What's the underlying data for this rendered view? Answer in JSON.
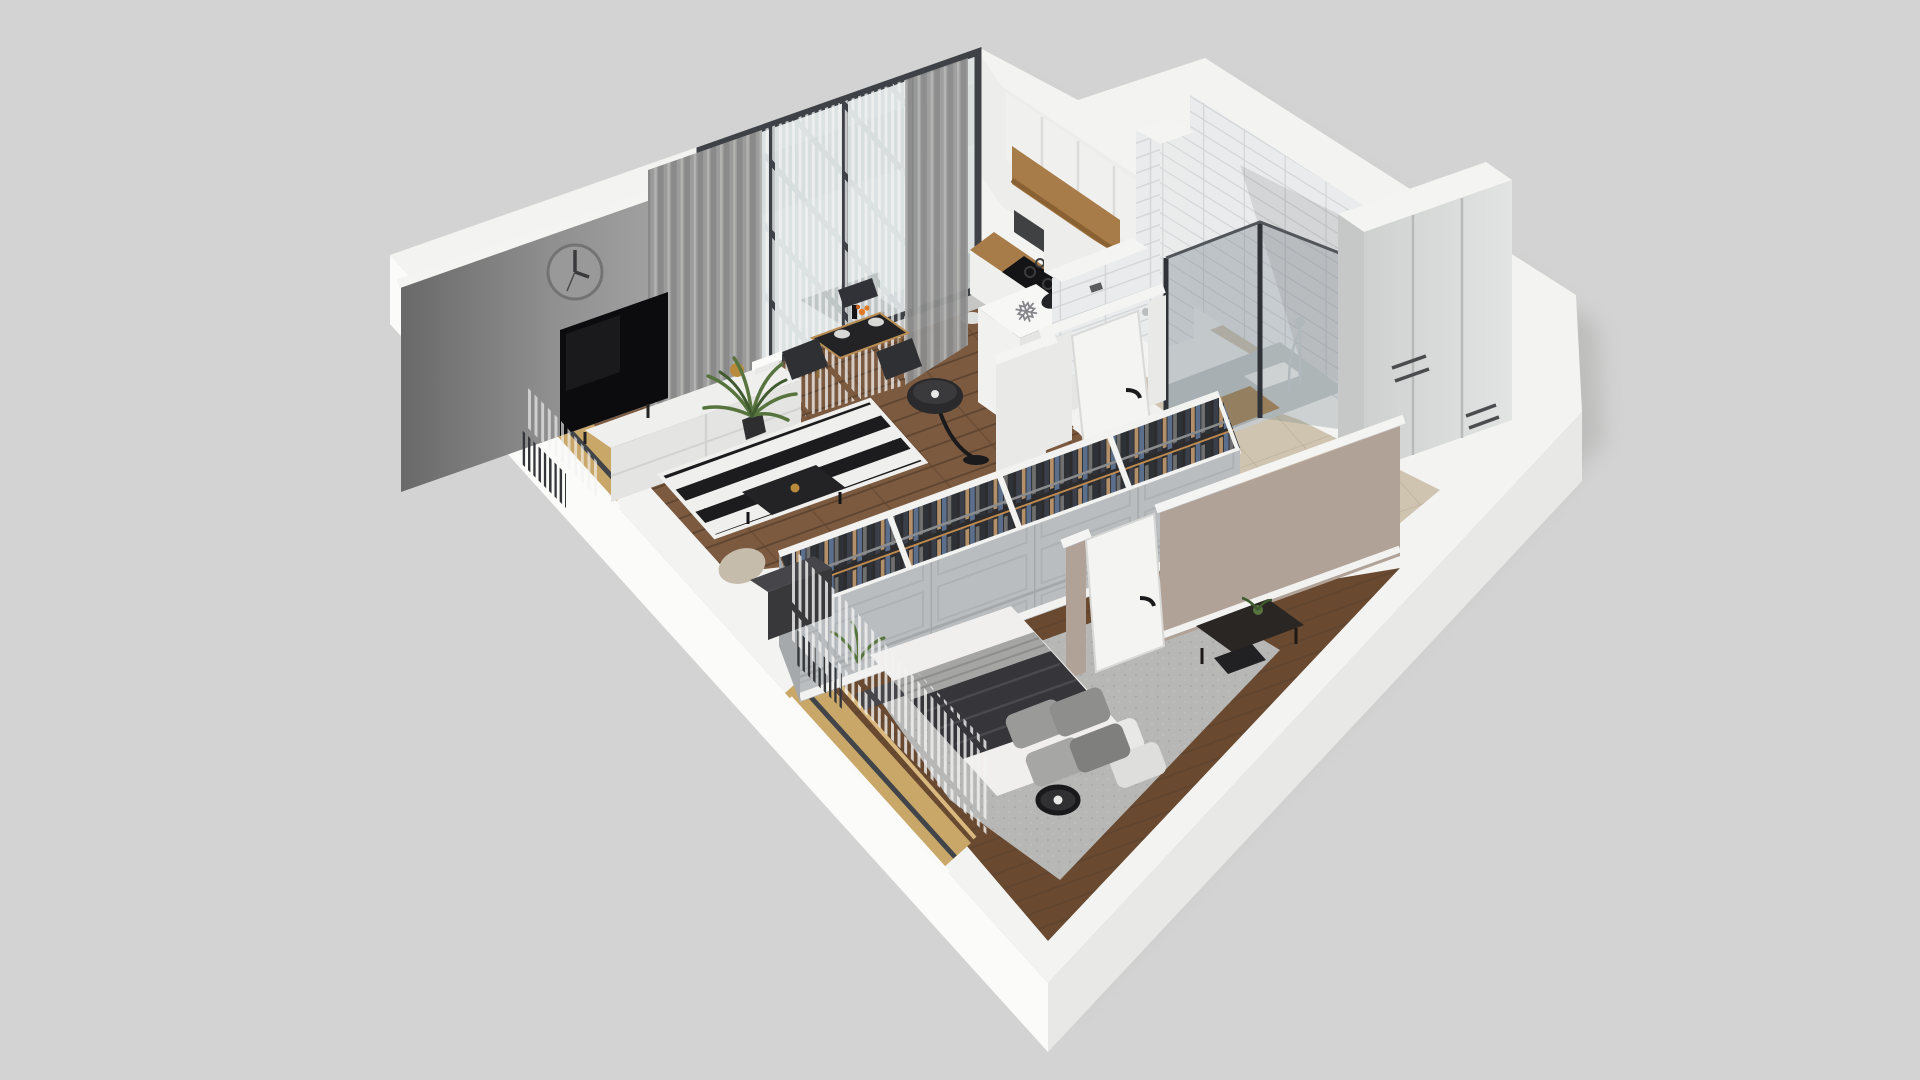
{
  "scene": {
    "name": "isometric-apartment-3d-floorplan-render",
    "view": "axonometric-dollhouse-cutaway",
    "background": "#d3d3d3"
  },
  "icons": {
    "snowflake": "❅"
  },
  "palette": {
    "background": "#d3d3d3",
    "shadow": "#8e8e8c",
    "wall_top_white": "#f3f3f1",
    "exterior_wall_bright": "#fbfbfa",
    "exterior_wall_shaded": "#e8e8e6",
    "interior_wall_white": "#ededeb",
    "interior_wall_shaded": "#dededc",
    "accent_wall_dark": "#696969",
    "accent_wall_mid": "#8f8f8f",
    "accent_wall_light": "#a8a8a8",
    "mauve_wall": "#b1a298",
    "wood_floor": "#7c5a40",
    "wood_floor_dark": "#69492f",
    "wood_line": "#5f4530",
    "carpet": "#b7b7b5",
    "carpet_dot": "#a6a6a4",
    "rug_black": "#1c1c1e",
    "rug_white": "#efefed",
    "beige_tile": "#cfc4b0",
    "beige_tile_line": "#bcb19d",
    "gray_tile": "#c6c6c4",
    "gray_tile_line": "#b2b2b0",
    "subway_tile": "#e9ebec",
    "subway_tile_shaded": "#dde0e2",
    "subway_line": "#d2d5d7",
    "mosaic_white": "#f0f0ee",
    "mosaic_dot": "#2e2e30",
    "oak_wood": "#a87c48",
    "oak_dark": "#8a6132",
    "gold_frame": "#c9a768",
    "glass_blue": "#b9c6cb",
    "frame_dark": "#3e4247",
    "shower_glass": "#76848c",
    "charcoal": "#232325",
    "dark_furniture": "#3b3d40",
    "light_furniture": "#d9dbda",
    "white_furniture": "#efefee",
    "mattress_white": "#f0efed",
    "pillow_gray": "#9a9a98",
    "pillow_dark": "#85858",
    "throw_dark": "#35353a",
    "blanket_gray": "#a5a5a3",
    "curtain_gray": "#9c9c9c",
    "curtain_gray_dark": "#8a8a8a",
    "sheer_white": "#f2f2f2",
    "plant_green": "#57743f",
    "plant_green_dark": "#3f5a2e",
    "beige_fabric": "#c6bcab",
    "accent_orange": "#e07a28",
    "chrome": "#c9ced1",
    "door_white": "#f4f4f2",
    "toilet_white": "#dcdedd",
    "clothes_navy": "#3a3f4a",
    "clothes_tan": "#b3906a",
    "clothes_denim": "#5b6e8c",
    "clothes_gray": "#6f6f6f",
    "closet_panel": "#b9bdbf"
  },
  "rooms": {
    "living_room": {
      "label": "living-room",
      "items": [
        "wall-clock",
        "tv",
        "tv-console",
        "gray-accent-wall",
        "curtains",
        "balcony-glass-doors",
        "dining-table",
        "dining-chairs",
        "floor-lamp",
        "striped-rug",
        "coffee-table",
        "pouf",
        "palm-plant",
        "radiator",
        "gold-frame-window"
      ]
    },
    "balcony": {
      "label": "balcony",
      "items": [
        "lounge-chair",
        "gray-tile-floor",
        "parapet"
      ]
    },
    "kitchen": {
      "label": "kitchen",
      "items": [
        "upper-cabinets",
        "wood-shelf",
        "countertop",
        "cooktop",
        "oven",
        "refrigerator",
        "snowflake-marker"
      ]
    },
    "bathroom": {
      "label": "bathroom",
      "items": [
        "shower-enclosure",
        "shower-tray",
        "wood-mat",
        "toilet",
        "subway-tile-walls",
        "tiled-column",
        "mosaic-floor",
        "door"
      ]
    },
    "hallway": {
      "label": "hallway",
      "items": [
        "tall-wardrobe-cabinet",
        "beige-tile-floor",
        "white-doors"
      ]
    },
    "wardrobe": {
      "label": "open-wardrobe",
      "items": [
        "hanging-clothes",
        "clothes-rail",
        "panel-back"
      ]
    },
    "bedroom": {
      "label": "bedroom",
      "items": [
        "double-bed",
        "pillows",
        "dark-throw",
        "striped-blanket",
        "carpet-rug",
        "black-floor-lamp",
        "desk",
        "desk-plant",
        "gold-frame-window",
        "sheer-slat-curtains",
        "radiator",
        "mauve-accent-wall",
        "door",
        "dark-dresser"
      ]
    }
  }
}
